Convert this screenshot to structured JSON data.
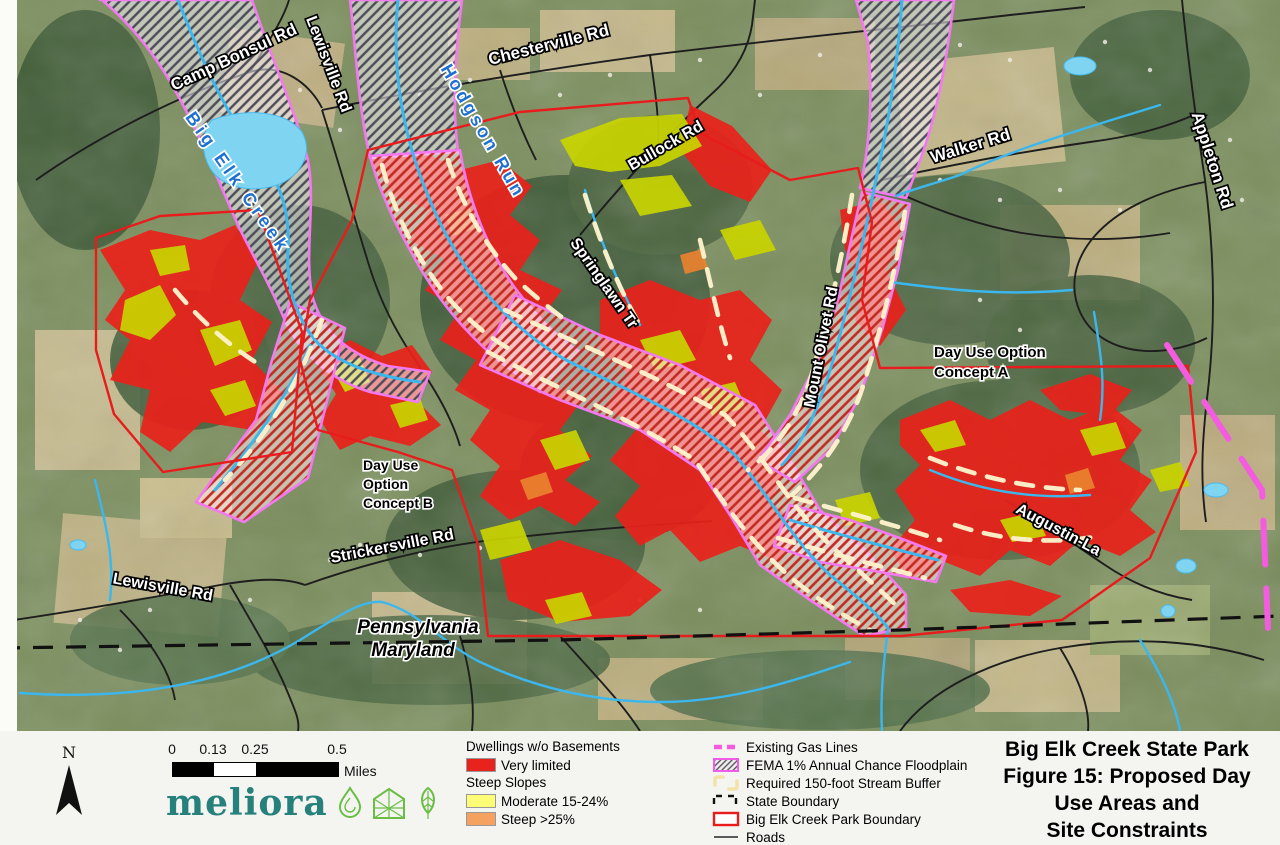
{
  "map": {
    "labels": [
      {
        "id": "camp-bonsul-rd",
        "text": "Camp Bonsul Rd",
        "x": 236,
        "y": 62,
        "rot": -25,
        "cls": "road",
        "size": 17
      },
      {
        "id": "lewisville-rd-top",
        "text": "Lewisville Rd",
        "x": 324,
        "y": 66,
        "rot": 69,
        "cls": "road",
        "size": 16
      },
      {
        "id": "chesterville-rd",
        "text": "Chesterville Rd",
        "x": 550,
        "y": 50,
        "rot": -14,
        "cls": "road",
        "size": 17
      },
      {
        "id": "hodgson-run",
        "text": "Hodgson Run",
        "x": 478,
        "y": 134,
        "rot": 60,
        "cls": "water",
        "size": 18,
        "spacing": 3
      },
      {
        "id": "big-elk-creek",
        "text": "Big Elk Creek",
        "x": 233,
        "y": 186,
        "rot": 55,
        "cls": "water",
        "size": 18,
        "spacing": 4
      },
      {
        "id": "bullock-rd",
        "text": "Bullock Rd",
        "x": 668,
        "y": 150,
        "rot": -30,
        "cls": "road",
        "size": 16
      },
      {
        "id": "springlawn-tr",
        "text": "Springlawn Tr",
        "x": 600,
        "y": 286,
        "rot": 55,
        "cls": "road",
        "size": 16
      },
      {
        "id": "mount-olivet-rd",
        "text": "Mount Olivet Rd",
        "x": 826,
        "y": 348,
        "rot": -79,
        "cls": "road",
        "size": 16
      },
      {
        "id": "walker-rd",
        "text": "Walker Rd",
        "x": 972,
        "y": 151,
        "rot": -17,
        "cls": "road",
        "size": 17
      },
      {
        "id": "appleton-rd",
        "text": "Appleton Rd",
        "x": 1207,
        "y": 162,
        "rot": 72,
        "cls": "road",
        "size": 17
      },
      {
        "id": "strickersville-rd",
        "text": "Strickersville Rd",
        "x": 393,
        "y": 551,
        "rot": -11,
        "cls": "road",
        "size": 16
      },
      {
        "id": "lewisville-rd-bottom",
        "text": "Lewisville Rd",
        "x": 162,
        "y": 592,
        "rot": 10,
        "cls": "road",
        "size": 16
      },
      {
        "id": "augustin-la",
        "text": "Augustin-La",
        "x": 1056,
        "y": 534,
        "rot": 28,
        "cls": "road",
        "size": 16
      },
      {
        "id": "day-use-a-line1",
        "text": "Day Use Option",
        "x": 934,
        "y": 357,
        "rot": 0,
        "cls": "note",
        "size": 15,
        "anchor": "start"
      },
      {
        "id": "day-use-a-line2",
        "text": "Concept A",
        "x": 934,
        "y": 377,
        "rot": 0,
        "cls": "note",
        "size": 15,
        "anchor": "start"
      },
      {
        "id": "day-use-b-line1",
        "text": "Day Use",
        "x": 363,
        "y": 470,
        "rot": 0,
        "cls": "note",
        "size": 14,
        "anchor": "start"
      },
      {
        "id": "day-use-b-line2",
        "text": "Option",
        "x": 363,
        "y": 489,
        "rot": 0,
        "cls": "note",
        "size": 14,
        "anchor": "start"
      },
      {
        "id": "day-use-b-line3",
        "text": "Concept B",
        "x": 363,
        "y": 508,
        "rot": 0,
        "cls": "note",
        "size": 14,
        "anchor": "start"
      },
      {
        "id": "state-pennsylvania",
        "text": "Pennsylvania",
        "x": 418,
        "y": 633,
        "rot": 0,
        "cls": "state",
        "size": 19
      },
      {
        "id": "state-maryland",
        "text": "Maryland",
        "x": 413,
        "y": 656,
        "rot": 0,
        "cls": "state",
        "size": 19
      }
    ]
  },
  "footer": {
    "north_label": "N",
    "scale": {
      "ticks": [
        "0",
        "0.13",
        "0.25",
        "0.5"
      ],
      "unit": "Miles"
    },
    "logo_text": "meliora",
    "legend_left": {
      "group1_title": "Dwellings w/o Basements",
      "item_very_limited": "Very limited",
      "group2_title": "Steep Slopes",
      "item_moderate": "Moderate 15-24%",
      "item_steep": "Steep >25%"
    },
    "legend_right": [
      {
        "symbol": "gas-line",
        "label": "Existing Gas Lines"
      },
      {
        "symbol": "fema-floodplain",
        "label": "FEMA 1% Annual Chance Floodplain"
      },
      {
        "symbol": "stream-buffer",
        "label": "Required 150-foot Stream Buffer"
      },
      {
        "symbol": "state-boundary",
        "label": "State Boundary"
      },
      {
        "symbol": "park-boundary",
        "label": "Big Elk Creek Park Boundary"
      },
      {
        "symbol": "roads",
        "label": "Roads"
      }
    ],
    "title_lines": [
      "Big Elk Creek State Park",
      "Figure 15:  Proposed Day",
      "Use Areas and",
      "Site Constraints"
    ]
  },
  "colors": {
    "very_limited_red": "#e8231d",
    "moderate_slope_yellow": "#fdfd77",
    "steep_slope_orange": "#f5a15f",
    "map_slope_yellow": "#c9d400",
    "floodplain_edge_magenta": "#f279ef",
    "gas_line_pink": "#f45ce0",
    "stream_buffer_cream": "#fdf2cc",
    "creek_blue": "#3bb7ee",
    "park_boundary_red": "#e81c1c",
    "logo_teal": "#26807b",
    "logo_green": "#6abe45"
  }
}
